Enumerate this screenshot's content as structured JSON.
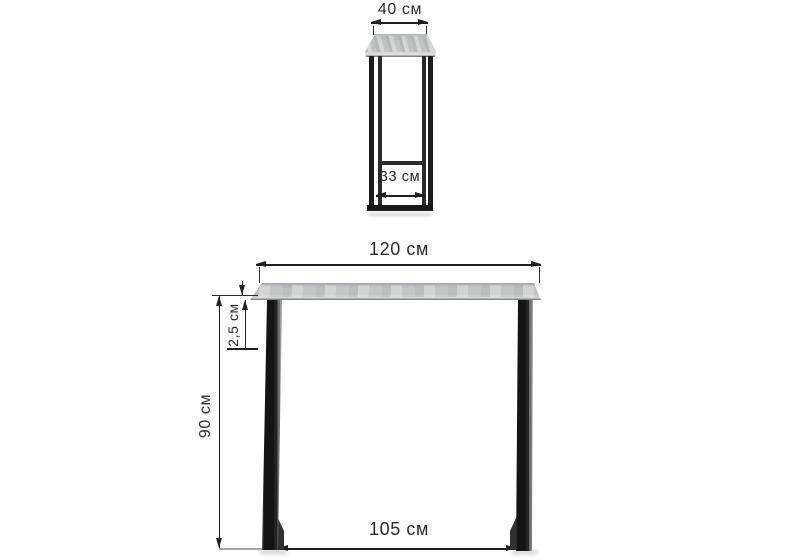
{
  "diagram": {
    "type": "furniture-dimension-drawing",
    "units": "см",
    "side_view": {
      "top_width_label": "40 см",
      "bottom_inner_width_label": "33 см"
    },
    "front_view": {
      "top_width_label": "120 см",
      "tabletop_thickness_label": "2,5 см",
      "height_label": "90 см",
      "leg_span_label": "105 см"
    }
  },
  "colors": {
    "background": "#ffffff",
    "dimension_line": "#1f1f1f",
    "text": "#2b2b2b",
    "metal_frame": "#1a1a1a",
    "tabletop_gray": "#cbcdcf",
    "tabletop_edge": "#8c8c8c"
  }
}
